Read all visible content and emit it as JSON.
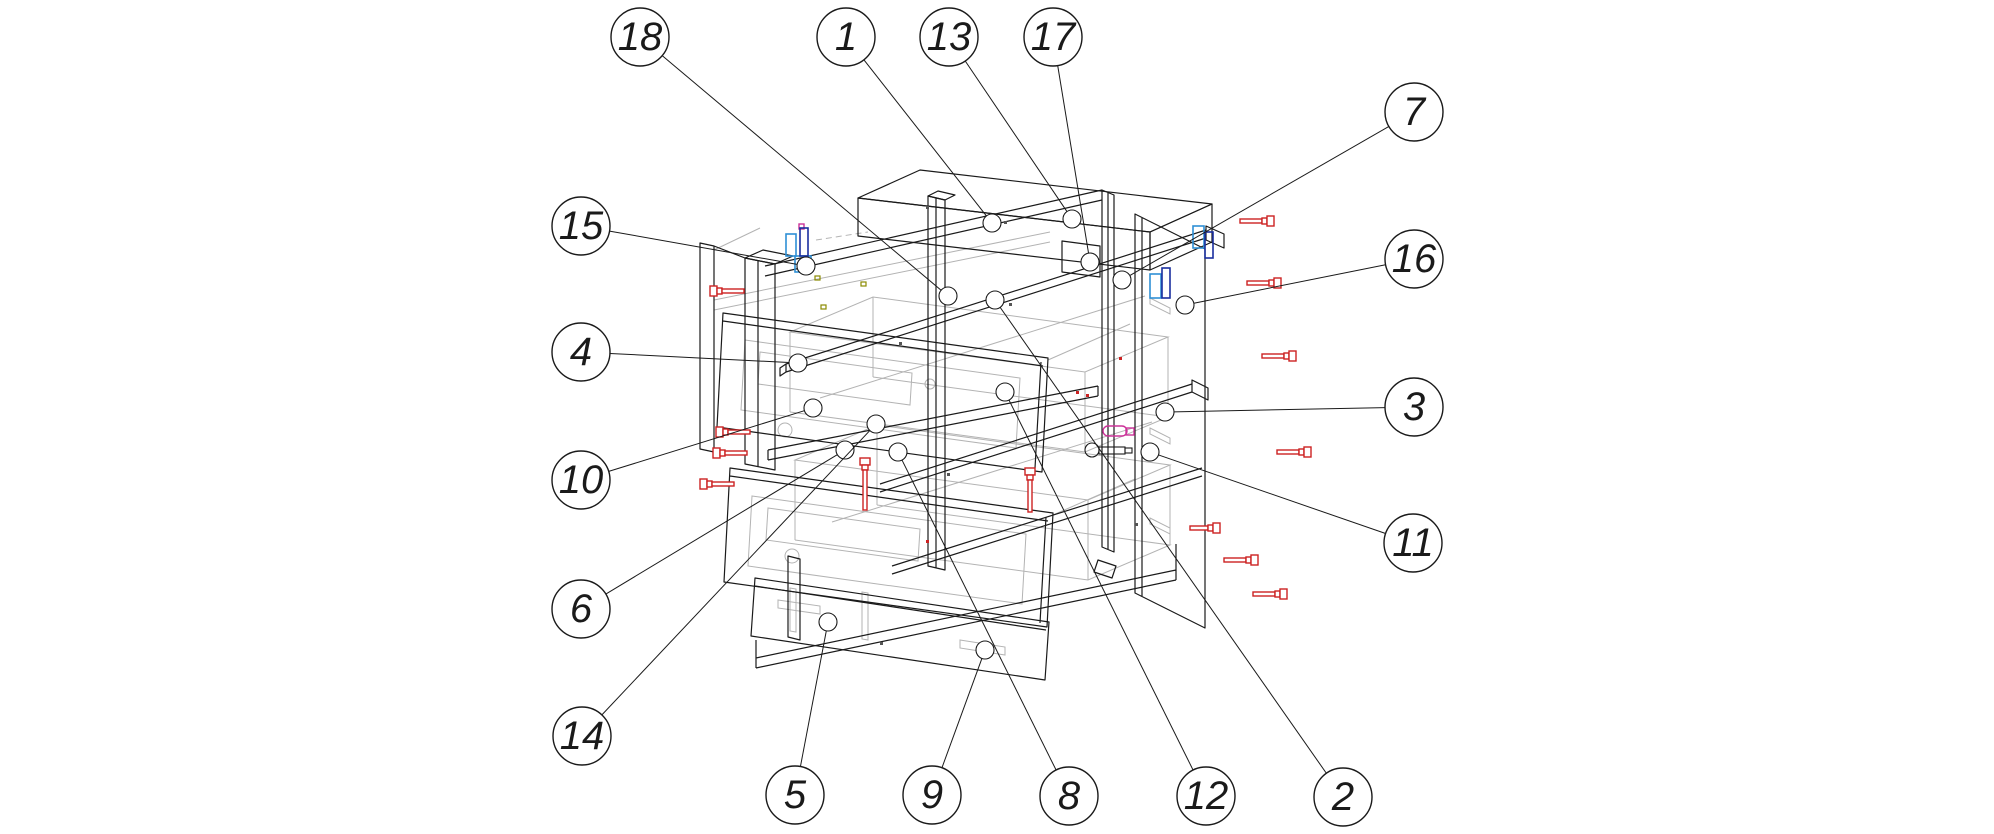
{
  "diagram": {
    "kind": "exploded-furniture-assembly-diagram",
    "background": "#ffffff",
    "colors": {
      "line": "#1a1a1a",
      "detail_gray": "#b3b3b3",
      "screw_red": "#cc2222",
      "bracket_light_blue": "#2e8fd5",
      "bracket_dark_blue": "#1a2f9e",
      "part_magenta": "#cc3399",
      "mark_olive": "#8a8a00"
    },
    "balloon_style": {
      "radius": 29,
      "ring_radius": 9,
      "font_size": 40
    },
    "balloons": [
      {
        "label": "18",
        "x": 640,
        "y": 37,
        "tx": 948,
        "ty": 296
      },
      {
        "label": "1",
        "x": 846,
        "y": 37,
        "tx": 992,
        "ty": 223
      },
      {
        "label": "13",
        "x": 949,
        "y": 37,
        "tx": 1072,
        "ty": 219
      },
      {
        "label": "17",
        "x": 1053,
        "y": 37,
        "tx": 1090,
        "ty": 262
      },
      {
        "label": "7",
        "x": 1414,
        "y": 112,
        "tx": 1122,
        "ty": 280
      },
      {
        "label": "16",
        "x": 1414,
        "y": 259,
        "tx": 1185,
        "ty": 305
      },
      {
        "label": "3",
        "x": 1414,
        "y": 407,
        "tx": 1165,
        "ty": 412
      },
      {
        "label": "11",
        "x": 1413,
        "y": 543,
        "tx": 1150,
        "ty": 452
      },
      {
        "label": "15",
        "x": 581,
        "y": 226,
        "tx": 806,
        "ty": 266
      },
      {
        "label": "4",
        "x": 581,
        "y": 352,
        "tx": 798,
        "ty": 363
      },
      {
        "label": "10",
        "x": 581,
        "y": 480,
        "tx": 813,
        "ty": 408
      },
      {
        "label": "6",
        "x": 581,
        "y": 609,
        "tx": 845,
        "ty": 450
      },
      {
        "label": "14",
        "x": 582,
        "y": 736,
        "tx": 876,
        "ty": 424
      },
      {
        "label": "5",
        "x": 795,
        "y": 795,
        "tx": 828,
        "ty": 622
      },
      {
        "label": "9",
        "x": 932,
        "y": 795,
        "tx": 985,
        "ty": 650
      },
      {
        "label": "8",
        "x": 1069,
        "y": 796,
        "tx": 898,
        "ty": 452
      },
      {
        "label": "12",
        "x": 1206,
        "y": 796,
        "tx": 1005,
        "ty": 392
      },
      {
        "label": "2",
        "x": 1343,
        "y": 797,
        "tx": 995,
        "ty": 300
      }
    ],
    "screws": [
      {
        "x": 710,
        "y": 291,
        "dir": "right",
        "len": 34
      },
      {
        "x": 716,
        "y": 432,
        "dir": "right",
        "len": 34
      },
      {
        "x": 713,
        "y": 453,
        "dir": "right",
        "len": 34
      },
      {
        "x": 700,
        "y": 484,
        "dir": "right",
        "len": 34
      },
      {
        "x": 1240,
        "y": 221,
        "dir": "left",
        "len": 34
      },
      {
        "x": 1247,
        "y": 283,
        "dir": "left",
        "len": 34
      },
      {
        "x": 1262,
        "y": 356,
        "dir": "left",
        "len": 34
      },
      {
        "x": 1277,
        "y": 452,
        "dir": "left",
        "len": 34
      },
      {
        "x": 1190,
        "y": 528,
        "dir": "left",
        "len": 30
      },
      {
        "x": 1224,
        "y": 560,
        "dir": "left",
        "len": 34
      },
      {
        "x": 1253,
        "y": 594,
        "dir": "left",
        "len": 34
      },
      {
        "x": 865,
        "y": 458,
        "dir": "down",
        "len": 52
      },
      {
        "x": 1030,
        "y": 468,
        "dir": "down",
        "len": 44
      }
    ],
    "brackets": [
      {
        "x": 786,
        "y": 234,
        "w": 10,
        "h": 22,
        "tone": "light"
      },
      {
        "x": 795,
        "y": 256,
        "w": 16,
        "h": 16,
        "tone": "light"
      },
      {
        "x": 800,
        "y": 228,
        "w": 8,
        "h": 28,
        "tone": "dark"
      },
      {
        "x": 1193,
        "y": 226,
        "w": 11,
        "h": 22,
        "tone": "light"
      },
      {
        "x": 1205,
        "y": 232,
        "w": 8,
        "h": 26,
        "tone": "dark"
      },
      {
        "x": 1150,
        "y": 274,
        "w": 11,
        "h": 24,
        "tone": "light"
      },
      {
        "x": 1162,
        "y": 268,
        "w": 8,
        "h": 30,
        "tone": "dark"
      }
    ]
  }
}
